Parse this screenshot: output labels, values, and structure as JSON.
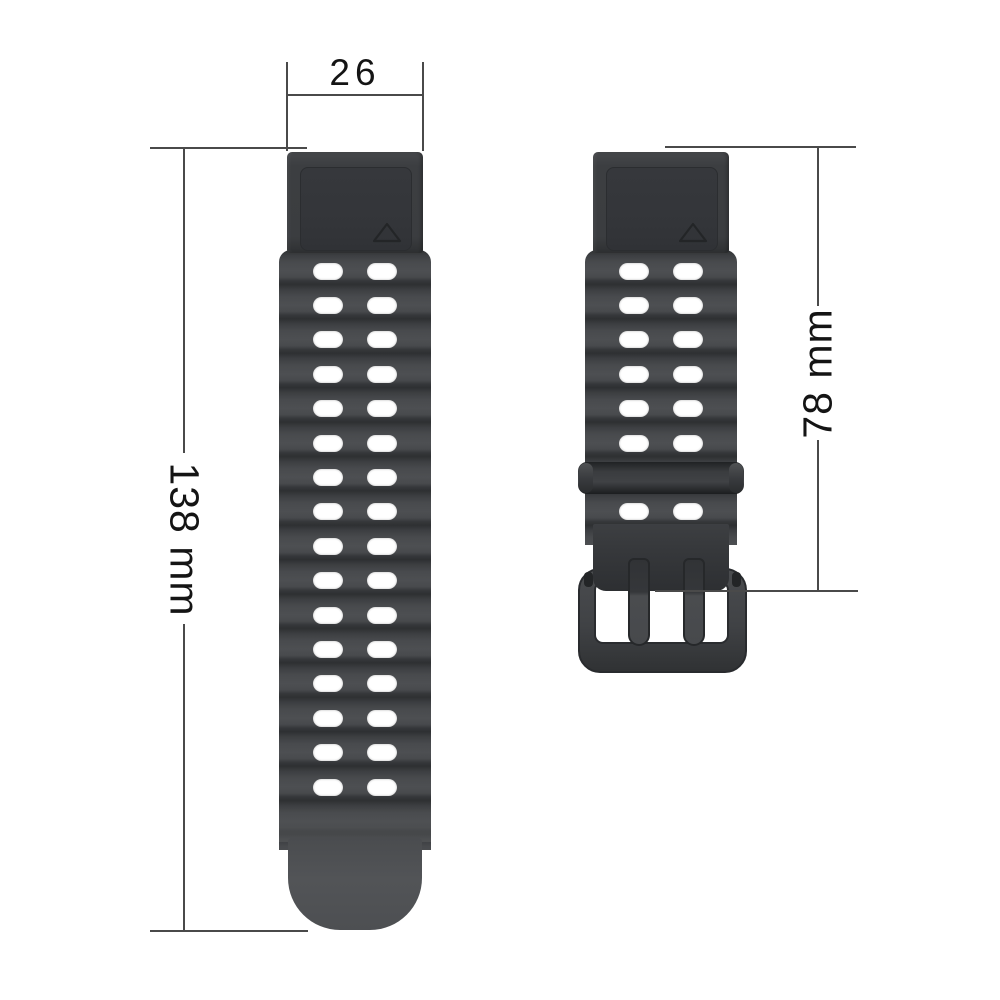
{
  "product": {
    "name": "two-piece silicone watch strap",
    "straps": {
      "left": {
        "hole_rows": 16,
        "hole_cols": 2,
        "has_lug_adapter": true,
        "has_rounded_tip": true
      },
      "right": {
        "hole_rows": 8,
        "hole_cols": 2,
        "has_lug_adapter": true,
        "has_keeper": true,
        "has_buckle": true,
        "keeper_covers_row": 7,
        "prongs": 2
      }
    }
  },
  "annotations": {
    "top_width": {
      "label": "26"
    },
    "left_length": {
      "label": "138 mm"
    },
    "right_length": {
      "label": "78 mm"
    }
  },
  "colors": {
    "background": "#ffffff",
    "strap_base": "#3e4043",
    "strap_ridge_dark": "#2e3032",
    "strap_ridge_light": "#4d4f52",
    "strap_tip": "#505254",
    "lug_panel": "#333539",
    "buckle": "#404245",
    "hole": "#ffffff",
    "dimension_line": "#4a4a4a",
    "dimension_text": "#141414"
  }
}
